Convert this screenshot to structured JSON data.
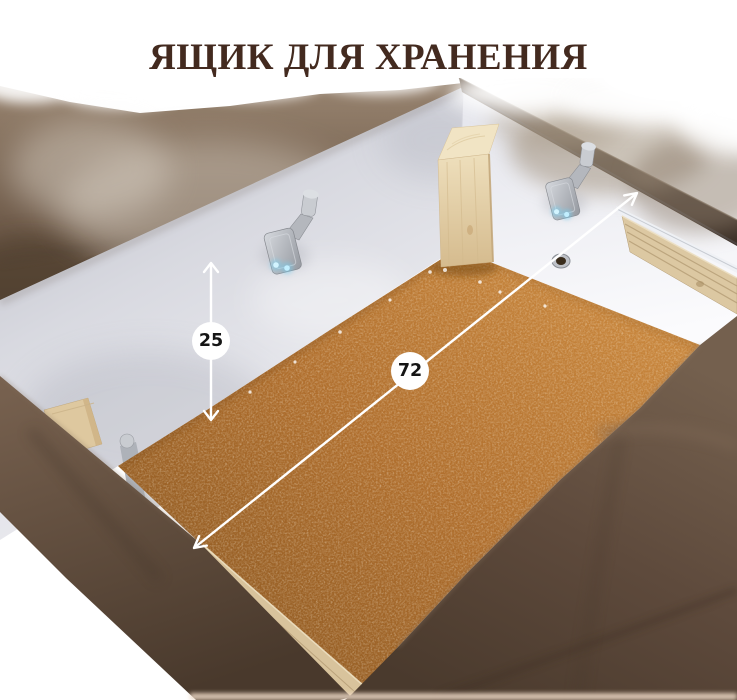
{
  "title": {
    "text": "ЯЩИК ДЛЯ ХРАНЕНИЯ"
  },
  "dimensions": {
    "height": {
      "value": "25"
    },
    "length": {
      "value": "72"
    }
  },
  "colors": {
    "background": "#ffffff",
    "title": "#432a1f",
    "annotation_line": "#ffffff",
    "annotation_badge": "#ffffff",
    "annotation_text": "#151515",
    "fabric_top": "#6e5a49",
    "fabric_front": "#55432f",
    "fabric_drape": "#5e4a3c",
    "wall": "#ececf2",
    "floor": "#b06f2e",
    "wood_post": "#e6d4ae",
    "plywood": "#d8c39c",
    "dark_rail": "#4a3c30",
    "hinge_metal": "#b9bcc2",
    "led_glow": "#8fdcf8"
  }
}
